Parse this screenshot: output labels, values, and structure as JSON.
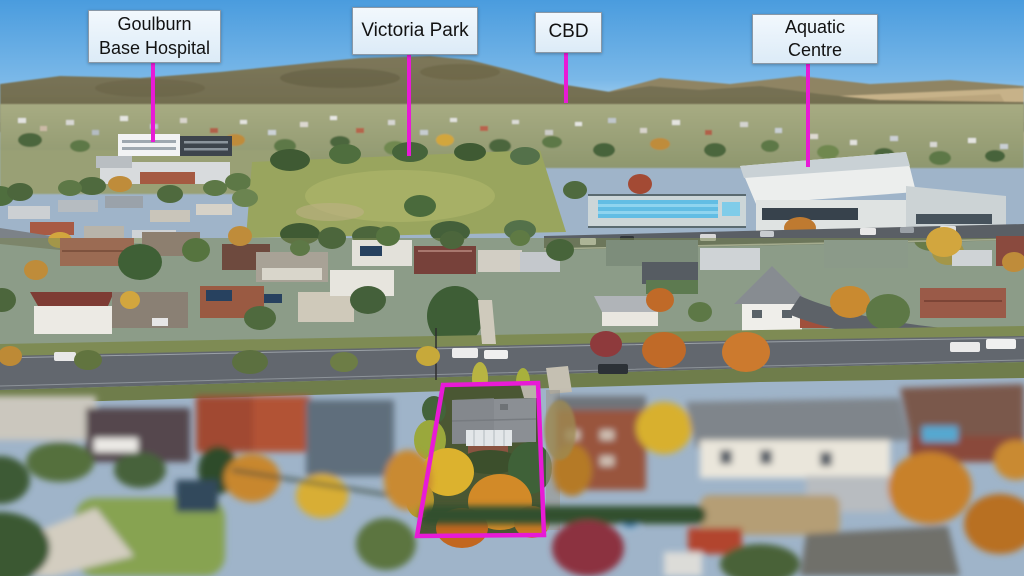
{
  "image_type": "aerial-suburb-photo-with-annotations",
  "annotations": {
    "accent_color": "#e81ad6",
    "label_box": {
      "background": "#e9f2fa",
      "border": "#8a98a6",
      "text_color": "#121212"
    },
    "labels": [
      {
        "id": "goulburn-base-hospital",
        "line1": "Goulburn",
        "line2": "Base Hospital"
      },
      {
        "id": "victoria-park",
        "line1": "Victoria Park",
        "line2": ""
      },
      {
        "id": "cbd",
        "line1": "CBD",
        "line2": ""
      },
      {
        "id": "aquatic-centre",
        "line1": "Aquatic",
        "line2": "Centre"
      }
    ],
    "property_boundary": {
      "shape": "quadrilateral",
      "color": "#e81ad6"
    }
  },
  "scene": {
    "sky_top_color": "#4a9cde",
    "sky_horizon_color": "#c3e0f4",
    "features": [
      "hills-ridge",
      "distant-township",
      "hospital-building",
      "victoria-park-lawn",
      "swimming-pool",
      "aquatic-centre-building",
      "main-road",
      "residential-houses",
      "tree-lined-street",
      "highlighted-property",
      "autumn-trees",
      "tilt-shift-blur-foreground"
    ]
  }
}
